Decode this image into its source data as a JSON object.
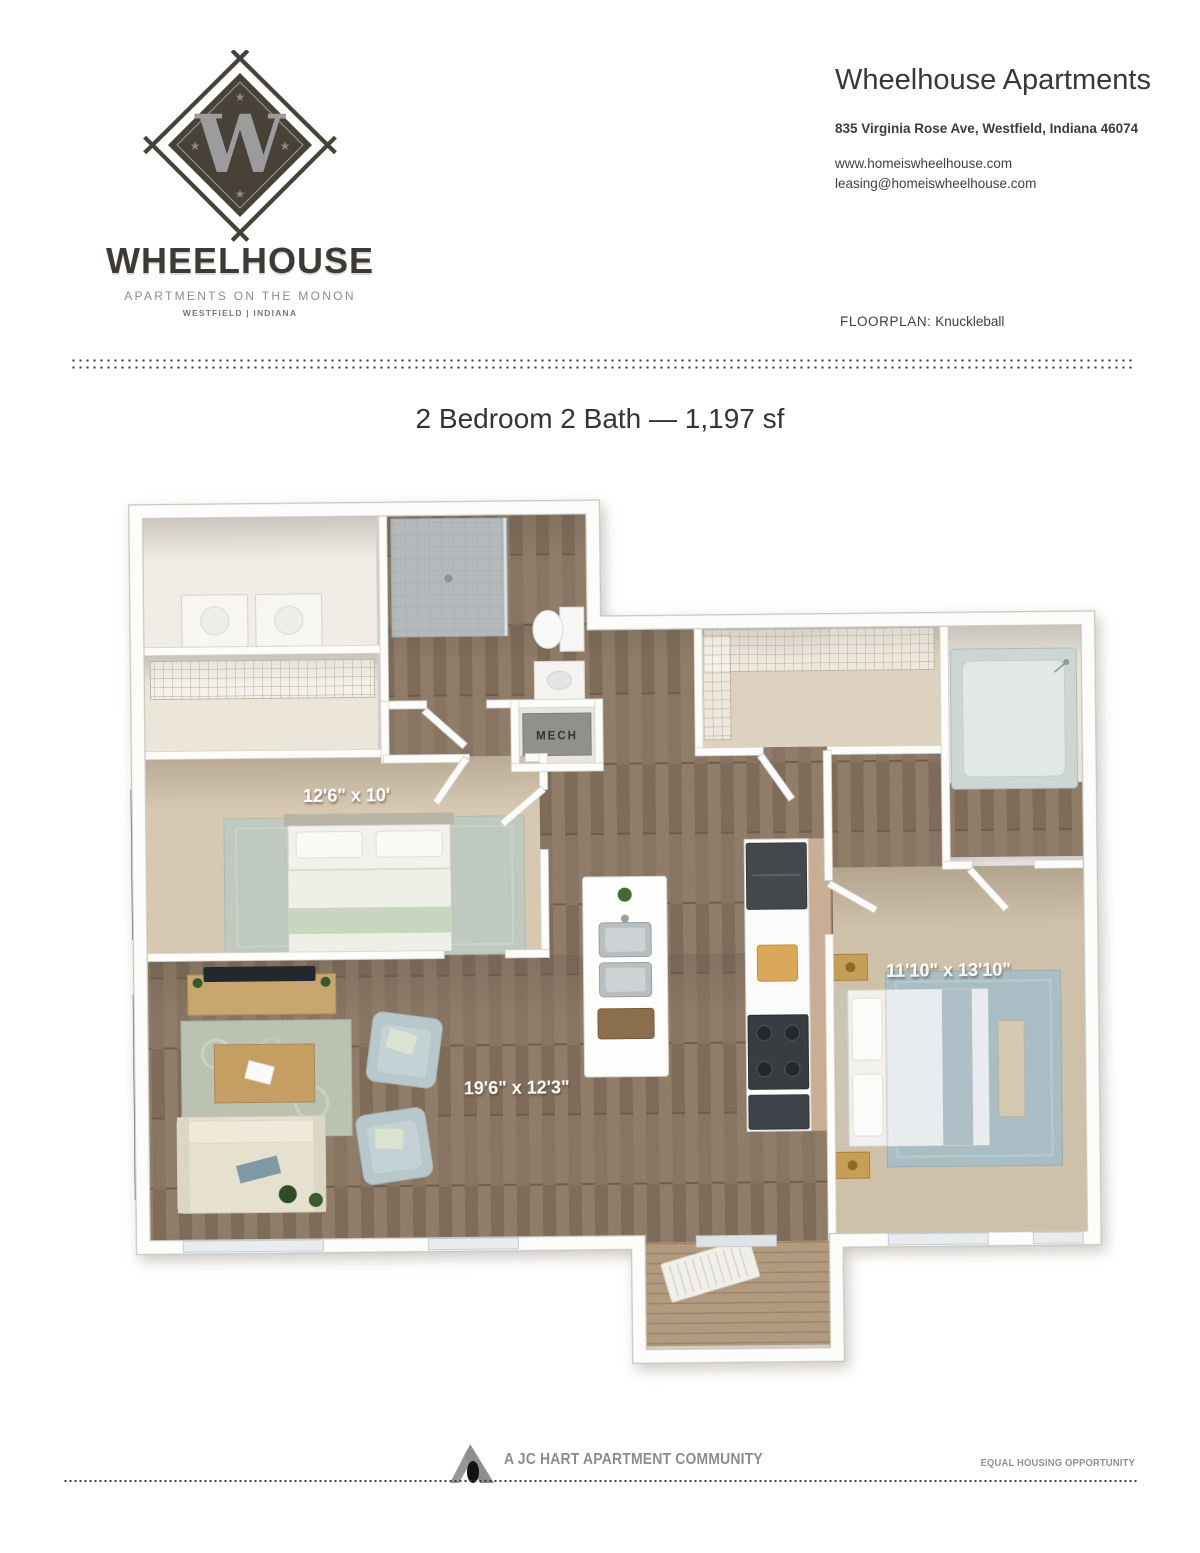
{
  "header": {
    "brand": {
      "monogram": "W",
      "name": "WHEELHOUSE",
      "tagline": "APARTMENTS ON THE MONON",
      "location": "WESTFIELD | INDIANA"
    },
    "property": {
      "name": "Wheelhouse Apartments",
      "address": "835 Virginia Rose Ave, Westfield, Indiana 46074",
      "website": "www.homeiswheelhouse.com",
      "email": "leasing@homeiswheelhouse.com"
    },
    "floorplan": {
      "label": "FLOORPLAN:",
      "name": "Knuckleball"
    }
  },
  "plan_title": "2 Bedroom 2 Bath — 1,197 sf",
  "floorplan": {
    "bedroom2_dim": "12'6\" x 10'",
    "master_dim": "11'10\" x 13'10\"",
    "living_dim": "19'6\" x 12'3\"",
    "mech_label": "MECH"
  },
  "footer": {
    "community": "A JC HART APARTMENT COMMUNITY",
    "equal_housing": "EQUAL HOUSING OPPORTUNITY"
  },
  "colors": {
    "brand_dark": "#3d3934",
    "brand_muted": "#908c83",
    "text": "#383838",
    "dots": "#3e3e3e",
    "wood": "#877462",
    "carpet": "#d7c8b2",
    "dim_label": "#ffffff"
  }
}
